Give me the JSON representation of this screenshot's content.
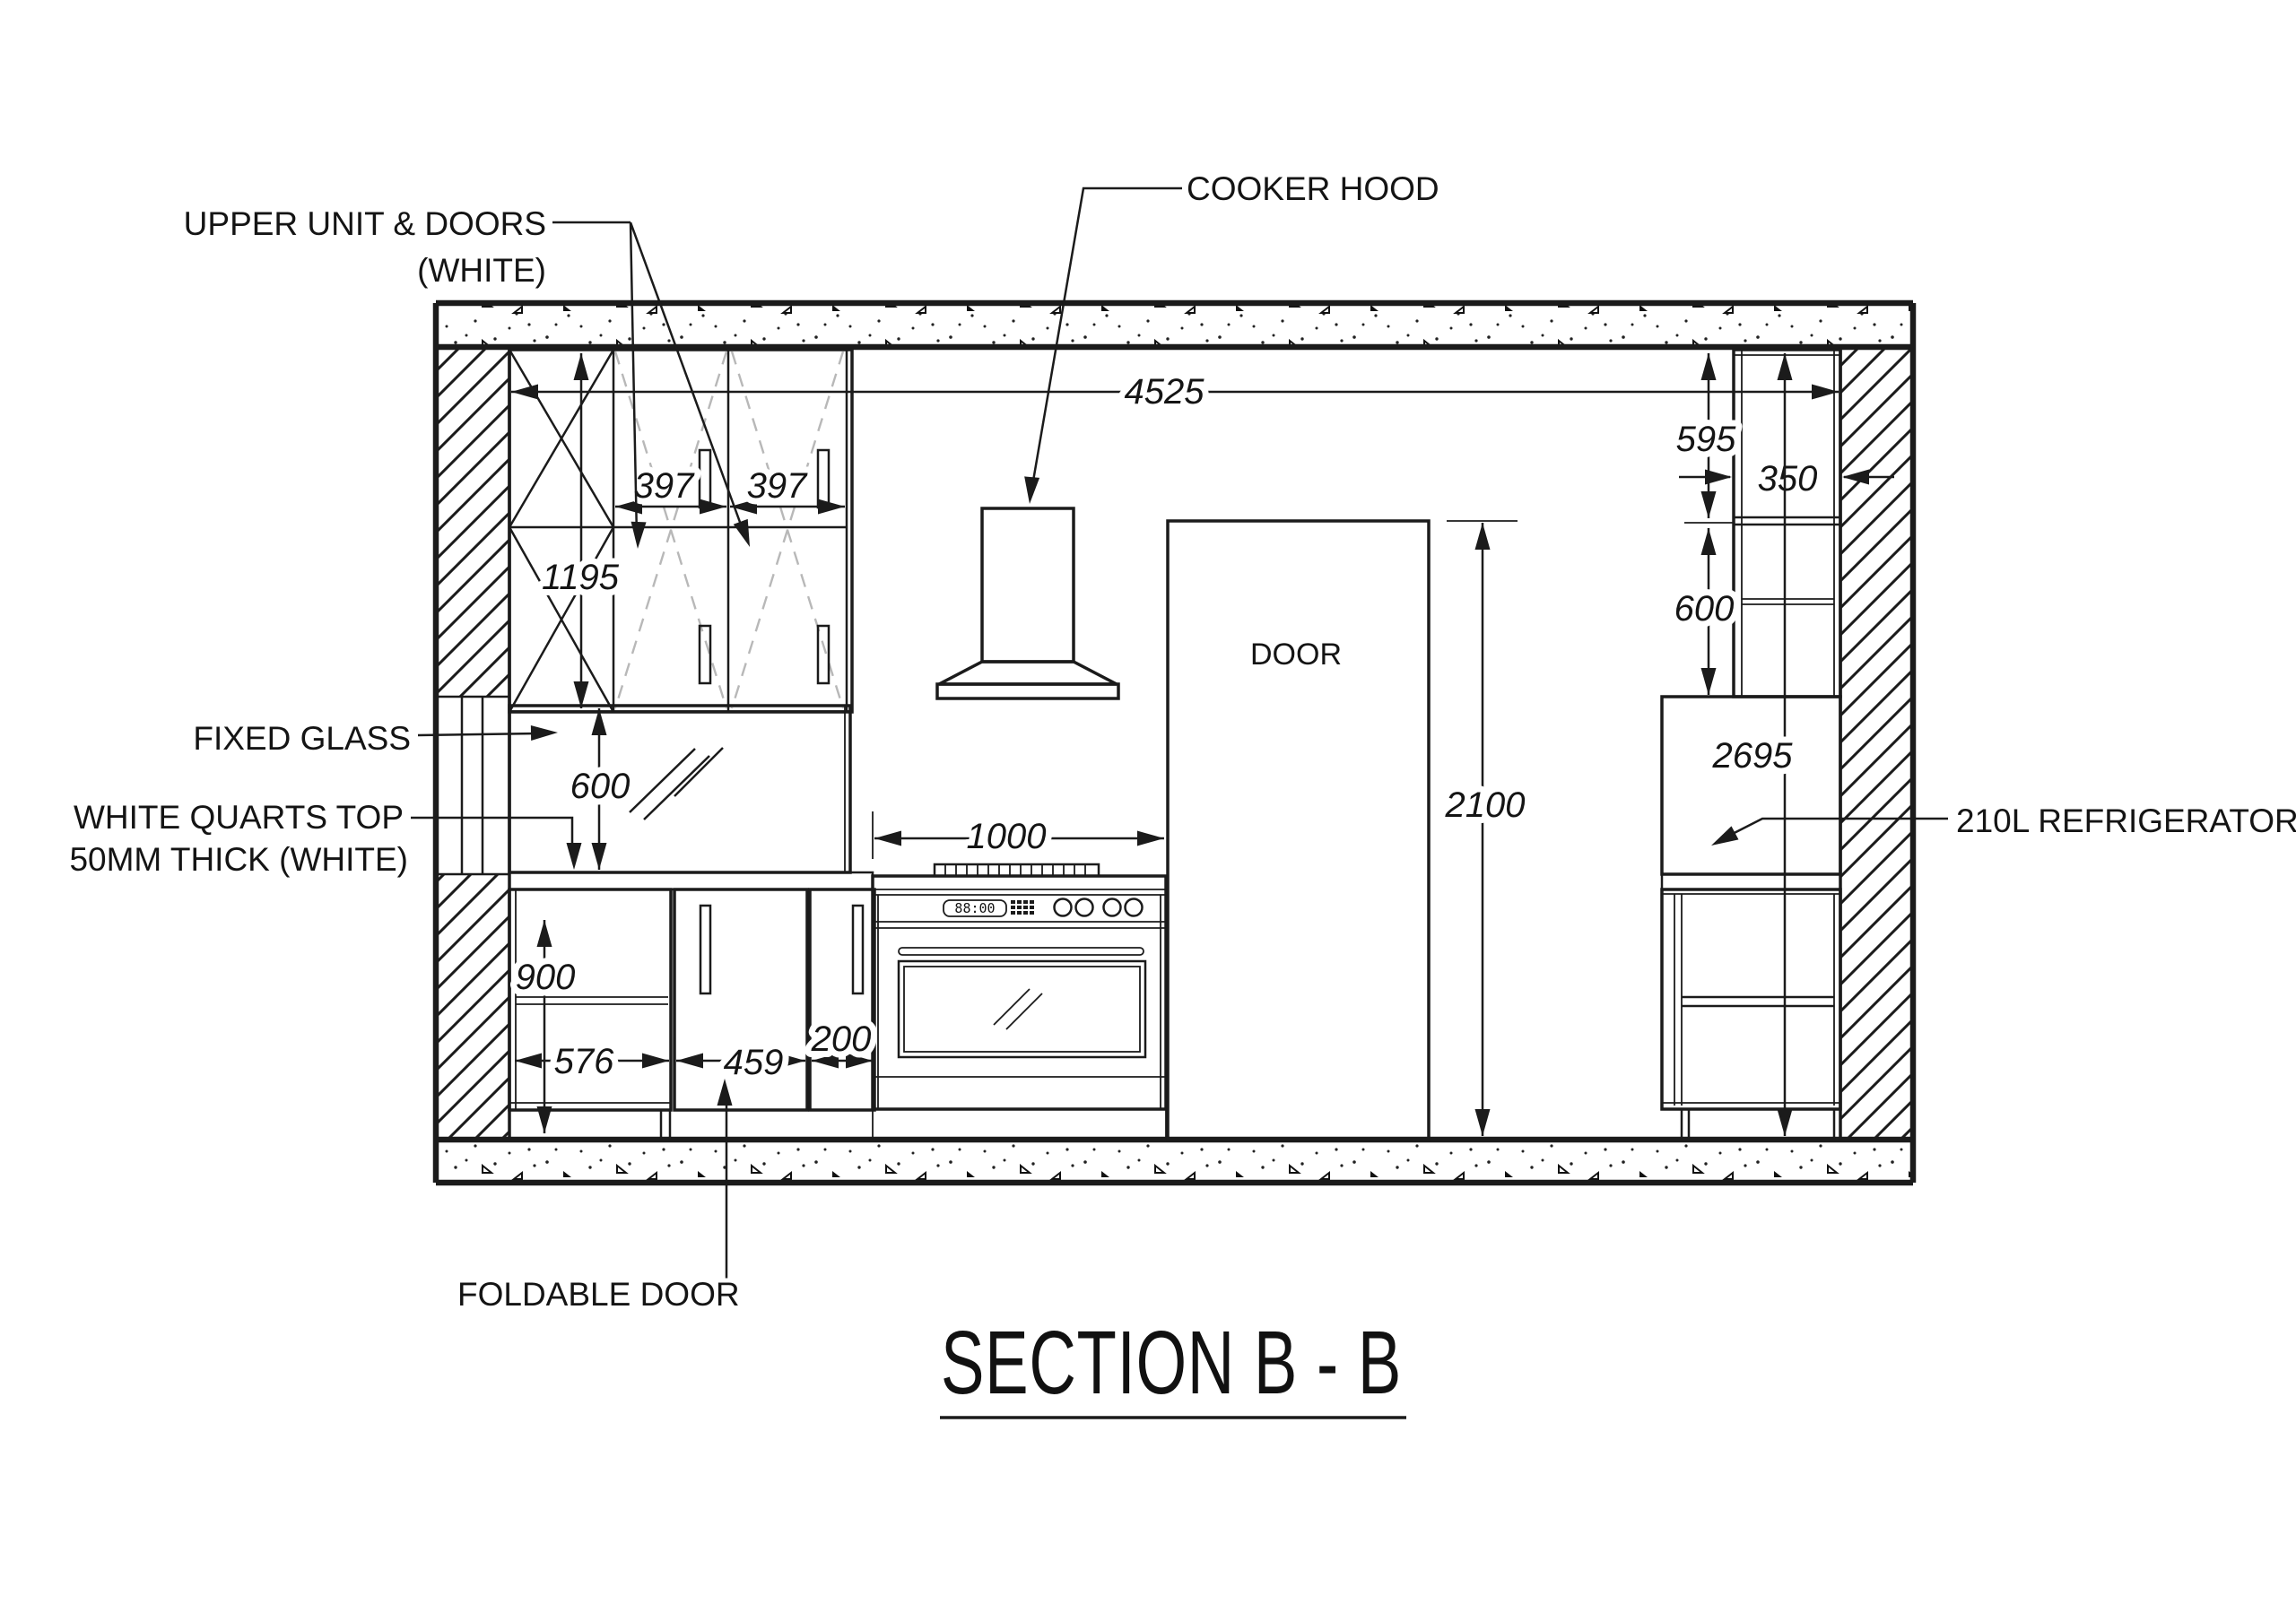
{
  "title": {
    "text": "SECTION B - B"
  },
  "labels": {
    "upper_unit_line1": "UPPER UNIT & DOORS",
    "upper_unit_line2": "(WHITE)",
    "cooker_hood": "COOKER HOOD",
    "fixed_glass": "FIXED GLASS",
    "quartz_line1": "WHITE QUARTS TOP",
    "quartz_line2": "50MM THICK (WHITE)",
    "foldable_door": "FOLDABLE DOOR",
    "refrigerator": "210L REFRIGERATOR",
    "door": "DOOR",
    "oven_display": "88:00"
  },
  "dimensions": {
    "overall_width": "4525",
    "upper_door_left": "397",
    "upper_door_right": "397",
    "upper_unit_height": "1195",
    "right_upper_top": "595",
    "right_upper_depth": "350",
    "right_upper_bottom": "600",
    "right_unit_height": "2695",
    "door_height": "2100",
    "cooktop_width": "1000",
    "backsplash_height": "600",
    "base_interior_height": "900",
    "base_open_width": "576",
    "foldable_width": "459",
    "narrow_width": "200"
  },
  "colors": {
    "line": "#1b1b1b",
    "dashed_hint": "#b8b8b8",
    "background": "#ffffff"
  }
}
